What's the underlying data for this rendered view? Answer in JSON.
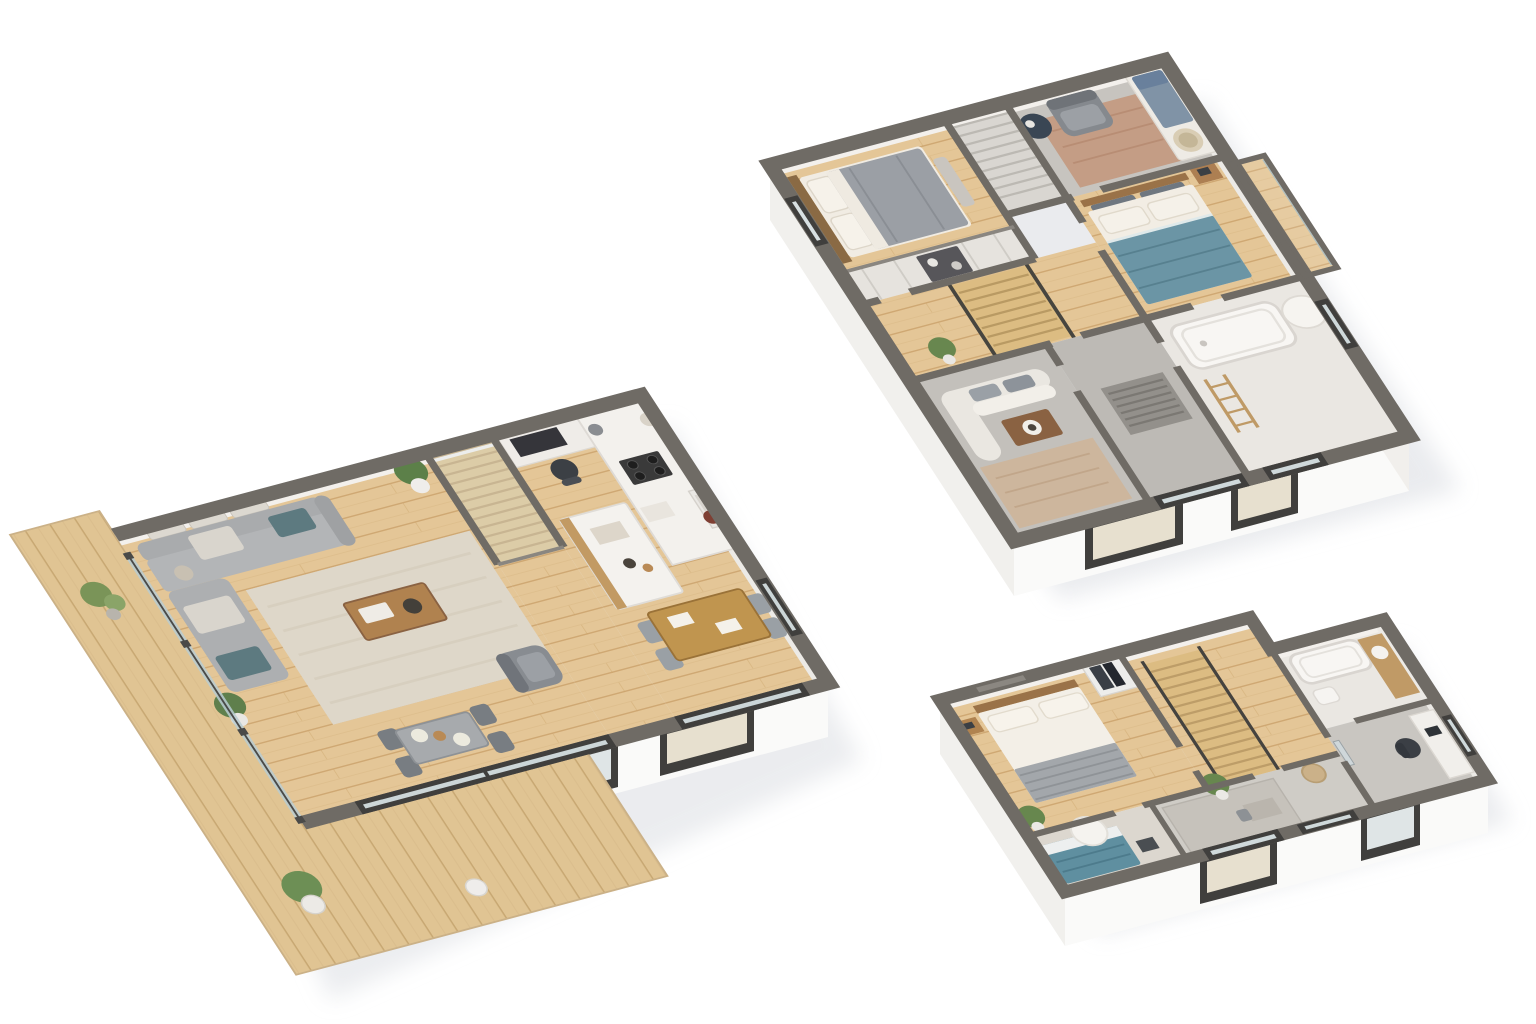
{
  "scene": {
    "description": "Three 3D isometric cutaway floor plans of a two-storey house on a white background",
    "palette": {
      "background": "#ffffff",
      "wall_top": "#6f6b65",
      "wall_face_white": "#f6f5f3",
      "wall_inner": "#f3f0ec",
      "wood_floor": "#e4c697",
      "wood_plank_line": "#cfa873",
      "deck_wood": "#e0c493",
      "carpet_gray": "#c6c3be",
      "tile_light": "#eae7e2",
      "sofa_gray": "#a9abad",
      "duvet_gray": "#9b9fa5",
      "duvet_teal": "#6b95a5",
      "bed_teal": "#5f8fa0",
      "accent_teal_cushion": "#5d7a80",
      "table_wood": "#b0824f",
      "stair_wood": "#dcbc82",
      "glass": "#dfe9ec",
      "window_frame_dark": "#403f3d",
      "plant_green": "#67874e",
      "rug_cream": "#ded7c9",
      "rug_terracotta": "#c49b82",
      "shadow": "#e3e5e9"
    }
  },
  "plans": [
    {
      "name": "upper-floor-plan",
      "position": "top-right",
      "rooms": [
        {
          "name": "bedroom-1",
          "floor": "wood",
          "furniture": [
            "double-bed-gray-duvet",
            "wood-headboard",
            "wardrobe-shelving",
            "dark-cabinet"
          ]
        },
        {
          "name": "stair-closet",
          "floor": "gray",
          "furniture": [
            "stairs-glass-panel"
          ]
        },
        {
          "name": "office-lounge",
          "floor": "carpet",
          "furniture": [
            "armchair-gray",
            "round-side-table",
            "terracotta-rug",
            "daybed-blue-mattress",
            "basket"
          ]
        },
        {
          "name": "bedroom-2",
          "floor": "wood",
          "furniture": [
            "double-bed-teal-duvet",
            "nightstand-wood",
            "headboard-cushions"
          ]
        },
        {
          "name": "landing",
          "floor": "wood",
          "furniture": [
            "staircase-wood",
            "handrails-dark",
            "potted-plant"
          ]
        },
        {
          "name": "sitting-nook",
          "floor": "carpet",
          "furniture": [
            "curved-sofa-white",
            "coffee-table-wood",
            "patterned-rug"
          ]
        },
        {
          "name": "hallway",
          "floor": "carpet",
          "furniture": [
            "striped-doormat",
            "glass-door"
          ]
        },
        {
          "name": "bathroom",
          "floor": "tile",
          "furniture": [
            "bathtub",
            "wood-ladder-shelf",
            "shower-curtain"
          ]
        },
        {
          "name": "balcony",
          "floor": "wood",
          "furniture": [
            "glass-railing"
          ]
        }
      ]
    },
    {
      "name": "ground-floor-plan",
      "position": "bottom-left",
      "rooms": [
        {
          "name": "living-room",
          "floor": "wood",
          "furniture": [
            "l-shaped-sofa-gray",
            "teal-cushions",
            "cream-cushions",
            "wall-cushions",
            "cream-rug",
            "coffee-table-wood",
            "tray-and-bowl",
            "potted-plants",
            "small-dining-table",
            "gray-chairs",
            "armchair-gray"
          ]
        },
        {
          "name": "staircase",
          "floor": "wood",
          "furniture": [
            "wood-steps",
            "glass-balustrade",
            "dark-handrails"
          ]
        },
        {
          "name": "kitchen",
          "floor": "wood",
          "furniture": [
            "media-desk",
            "tv-screen",
            "desk-chair",
            "white-counter",
            "stove-burners",
            "kitchen-island-wood-front",
            "sink-with-pot"
          ]
        },
        {
          "name": "dining-area",
          "floor": "wood",
          "furniture": [
            "dining-table-wood",
            "chairs",
            "papers"
          ]
        },
        {
          "name": "deck-terrace",
          "floor": "deck-planks",
          "furniture": [
            "bonsai-plant",
            "potted-shrub",
            "white-planter",
            "glass-balustrade-posts"
          ]
        },
        {
          "name": "sliding-glass-doors",
          "floor": "",
          "furniture": [
            "dark-framed-glazing"
          ]
        }
      ]
    },
    {
      "name": "loft-floor-plan",
      "position": "bottom-right",
      "rooms": [
        {
          "name": "bedroom-3",
          "floor": "wood",
          "furniture": [
            "double-bed-white",
            "striped-foot-blanket",
            "wood-headboard",
            "nightstand",
            "potted-plant",
            "wardrobe-with-clothes"
          ]
        },
        {
          "name": "stair-hall",
          "floor": "wood",
          "furniture": [
            "staircase-wood",
            "dark-handrails"
          ]
        },
        {
          "name": "bathroom-2",
          "floor": "tile",
          "furniture": [
            "bathtub",
            "wood-vanity",
            "sink",
            "toilet"
          ]
        },
        {
          "name": "study",
          "floor": "carpet",
          "furniture": [
            "desk-white",
            "office-chair-dark",
            "laptop",
            "mirror"
          ]
        },
        {
          "name": "guest-nook",
          "floor": "carpet",
          "furniture": [
            "single-bed-teal",
            "canopy-curtain",
            "dark-side-table"
          ]
        },
        {
          "name": "lower-hall",
          "floor": "carpet",
          "furniture": [
            "gray-rug",
            "small-desk-and-chair",
            "potted-plant",
            "basket",
            "glass-door"
          ]
        }
      ]
    }
  ]
}
